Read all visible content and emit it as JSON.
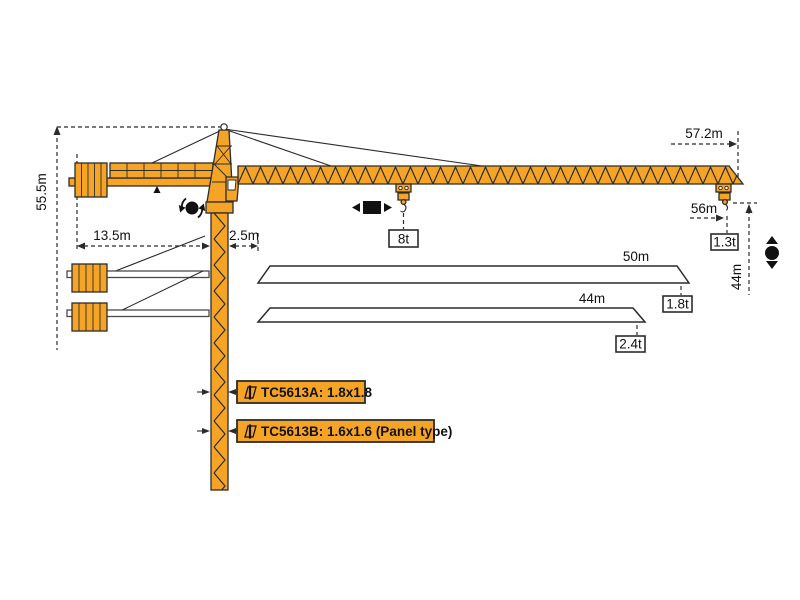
{
  "dimensions": {
    "total_height": "55.5m",
    "counter_jib_length": "13.5m",
    "slew_offset": "2.5m",
    "jib_length": "57.2m",
    "max_radius": "56m",
    "hook_travel": "44m"
  },
  "loads": {
    "max_load": "8t",
    "tip_load": "1.3t"
  },
  "jib_options": [
    {
      "length": "50m",
      "tip_load": "1.8t"
    },
    {
      "length": "44m",
      "tip_load": "2.4t"
    }
  ],
  "models": [
    {
      "name": "TC5613A: 1.8x1.8"
    },
    {
      "name": "TC5613B: 1.6x1.6 (Panel type)"
    }
  ],
  "colors": {
    "crane_orange": "#F6A426",
    "outline": "#2B2B2B",
    "icon_black": "#111111"
  }
}
